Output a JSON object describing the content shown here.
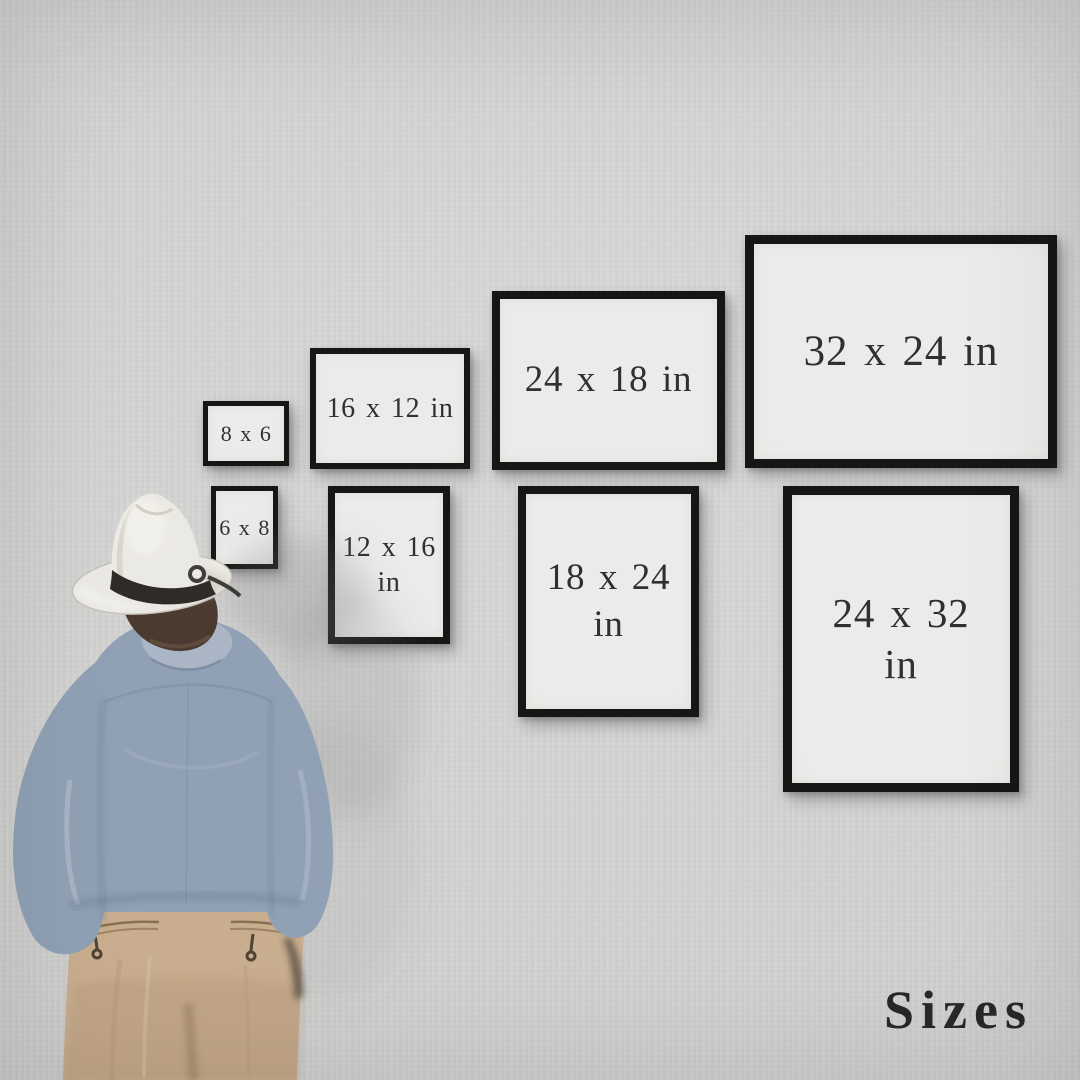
{
  "title": "Sizes",
  "figure": "man-in-white-fedora-back-view",
  "frames": [
    {
      "id": "8x6",
      "label": "8 x 6"
    },
    {
      "id": "6x8",
      "label": "6 x 8"
    },
    {
      "id": "16x12",
      "label": "16 x 12 in"
    },
    {
      "id": "12x16",
      "label": "12 x 16\nin"
    },
    {
      "id": "24x18",
      "label": "24 x 18 in"
    },
    {
      "id": "18x24",
      "label": "18 x 24\nin"
    },
    {
      "id": "32x24",
      "label": "32 x 24 in"
    },
    {
      "id": "24x32",
      "label": "24 x 32\nin"
    }
  ],
  "colors": {
    "wall": "#d2d2d1",
    "frame_border": "#171615",
    "frame_mat": "#edebe9",
    "label_text": "#2d3134",
    "title_text": "#26282a",
    "shirt": "#90a1b5",
    "shirt_collar": "#aab6c6",
    "pants": "#c8ad8e",
    "hat": "#ebe9e3",
    "hat_band": "#2f2c28",
    "hair": "#4b3a2f"
  }
}
